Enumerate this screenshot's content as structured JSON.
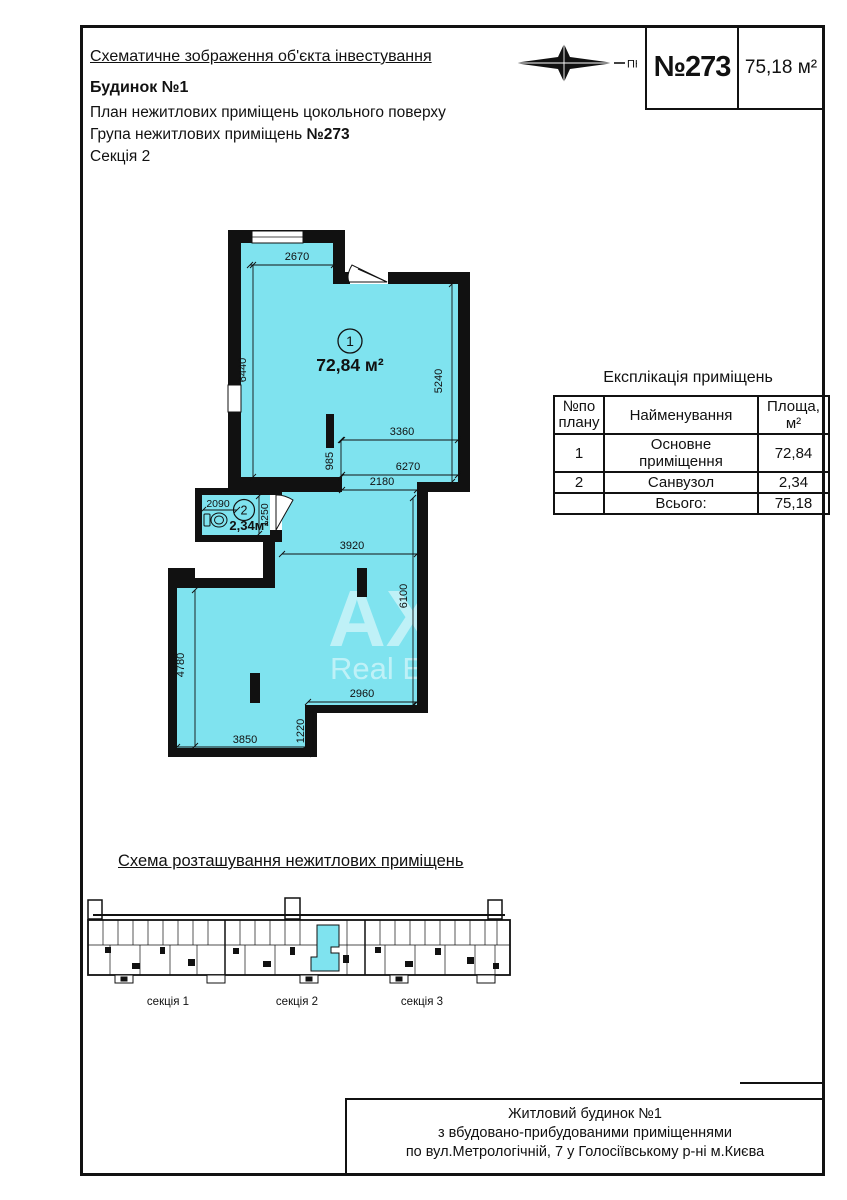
{
  "header": {
    "title": "Схематичне зображення об'єкта інвестування",
    "building": "Будинок №1",
    "plan_line": "План нежитлових приміщень цокольного поверху",
    "group_line_prefix": "Група нежитлових приміщень ",
    "group_number": "№273",
    "section_line": "Секція 2",
    "compass_label": "ПН"
  },
  "stamp": {
    "number": "№273",
    "area": "75,18 м²"
  },
  "plan": {
    "room1": {
      "number": "1",
      "area": "72,84 м²"
    },
    "room2": {
      "number": "2",
      "area": "2,34м²"
    },
    "dims": {
      "w2670": "2670",
      "h6440": "6440",
      "h5240": "5240",
      "w3360": "3360",
      "h985": "985",
      "w6270": "6270",
      "w2180": "2180",
      "w2090": "2090",
      "h1250": "1250",
      "w3920": "3920",
      "h6100": "6100",
      "h4780": "4780",
      "w2960": "2960",
      "h1220": "1220",
      "w3850": "3850"
    },
    "watermark": {
      "line1": "АХ",
      "line2": "Real Es"
    }
  },
  "table": {
    "title": "Експлікація приміщень",
    "headers": {
      "col1": "№по плану",
      "col2": "Найменування",
      "col3": "Площа, м²"
    },
    "rows": [
      {
        "n": "1",
        "name": "Основне приміщення",
        "area": "72,84"
      },
      {
        "n": "2",
        "name": "Санвузол",
        "area": "2,34"
      }
    ],
    "total_label": "Всього:",
    "total_value": "75,18"
  },
  "scheme": {
    "title": "Схема розташування нежитлових приміщень",
    "sections": [
      "секція 1",
      "секція 2",
      "секція 3"
    ]
  },
  "footer": {
    "line1": "Житловий будинок №1",
    "line2": "з вбудовано-прибудованими приміщеннями",
    "line3": "по вул.Метрологічній, 7 у Голосіївському р-ні м.Києва"
  },
  "colors": {
    "highlight": "#7fe3ef"
  }
}
